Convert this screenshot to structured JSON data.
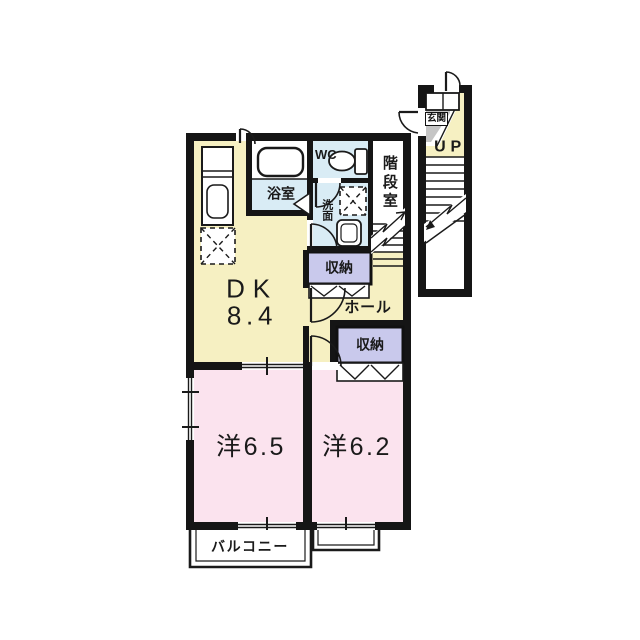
{
  "plan": {
    "rooms": {
      "dk": {
        "label": "DK",
        "area": "8.4"
      },
      "western_room_1": {
        "label": "洋6.5"
      },
      "western_room_2": {
        "label": "洋6.2"
      },
      "bathroom": {
        "label": "浴室"
      },
      "toilet": {
        "label": "WC"
      },
      "washroom": {
        "label": "洗面"
      },
      "stair_hall": {
        "label": "階段室"
      },
      "closet_upper": {
        "label": "収納"
      },
      "closet_lower": {
        "label": "収納"
      },
      "hall": {
        "label": "ホール"
      },
      "balcony": {
        "label": "バルコニー"
      },
      "entrance": {
        "label": "玄関"
      },
      "stairs_up": {
        "label": "UP"
      }
    },
    "colors": {
      "wall": "#151515",
      "living_floor": "#f6f0c2",
      "bedroom_floor": "#fbe3ee",
      "wet_area_floor": "#d9ecf5",
      "closet_fill": "#c9c9ec",
      "entrance_fill": "#c5c5c5",
      "background": "#ffffff"
    }
  }
}
